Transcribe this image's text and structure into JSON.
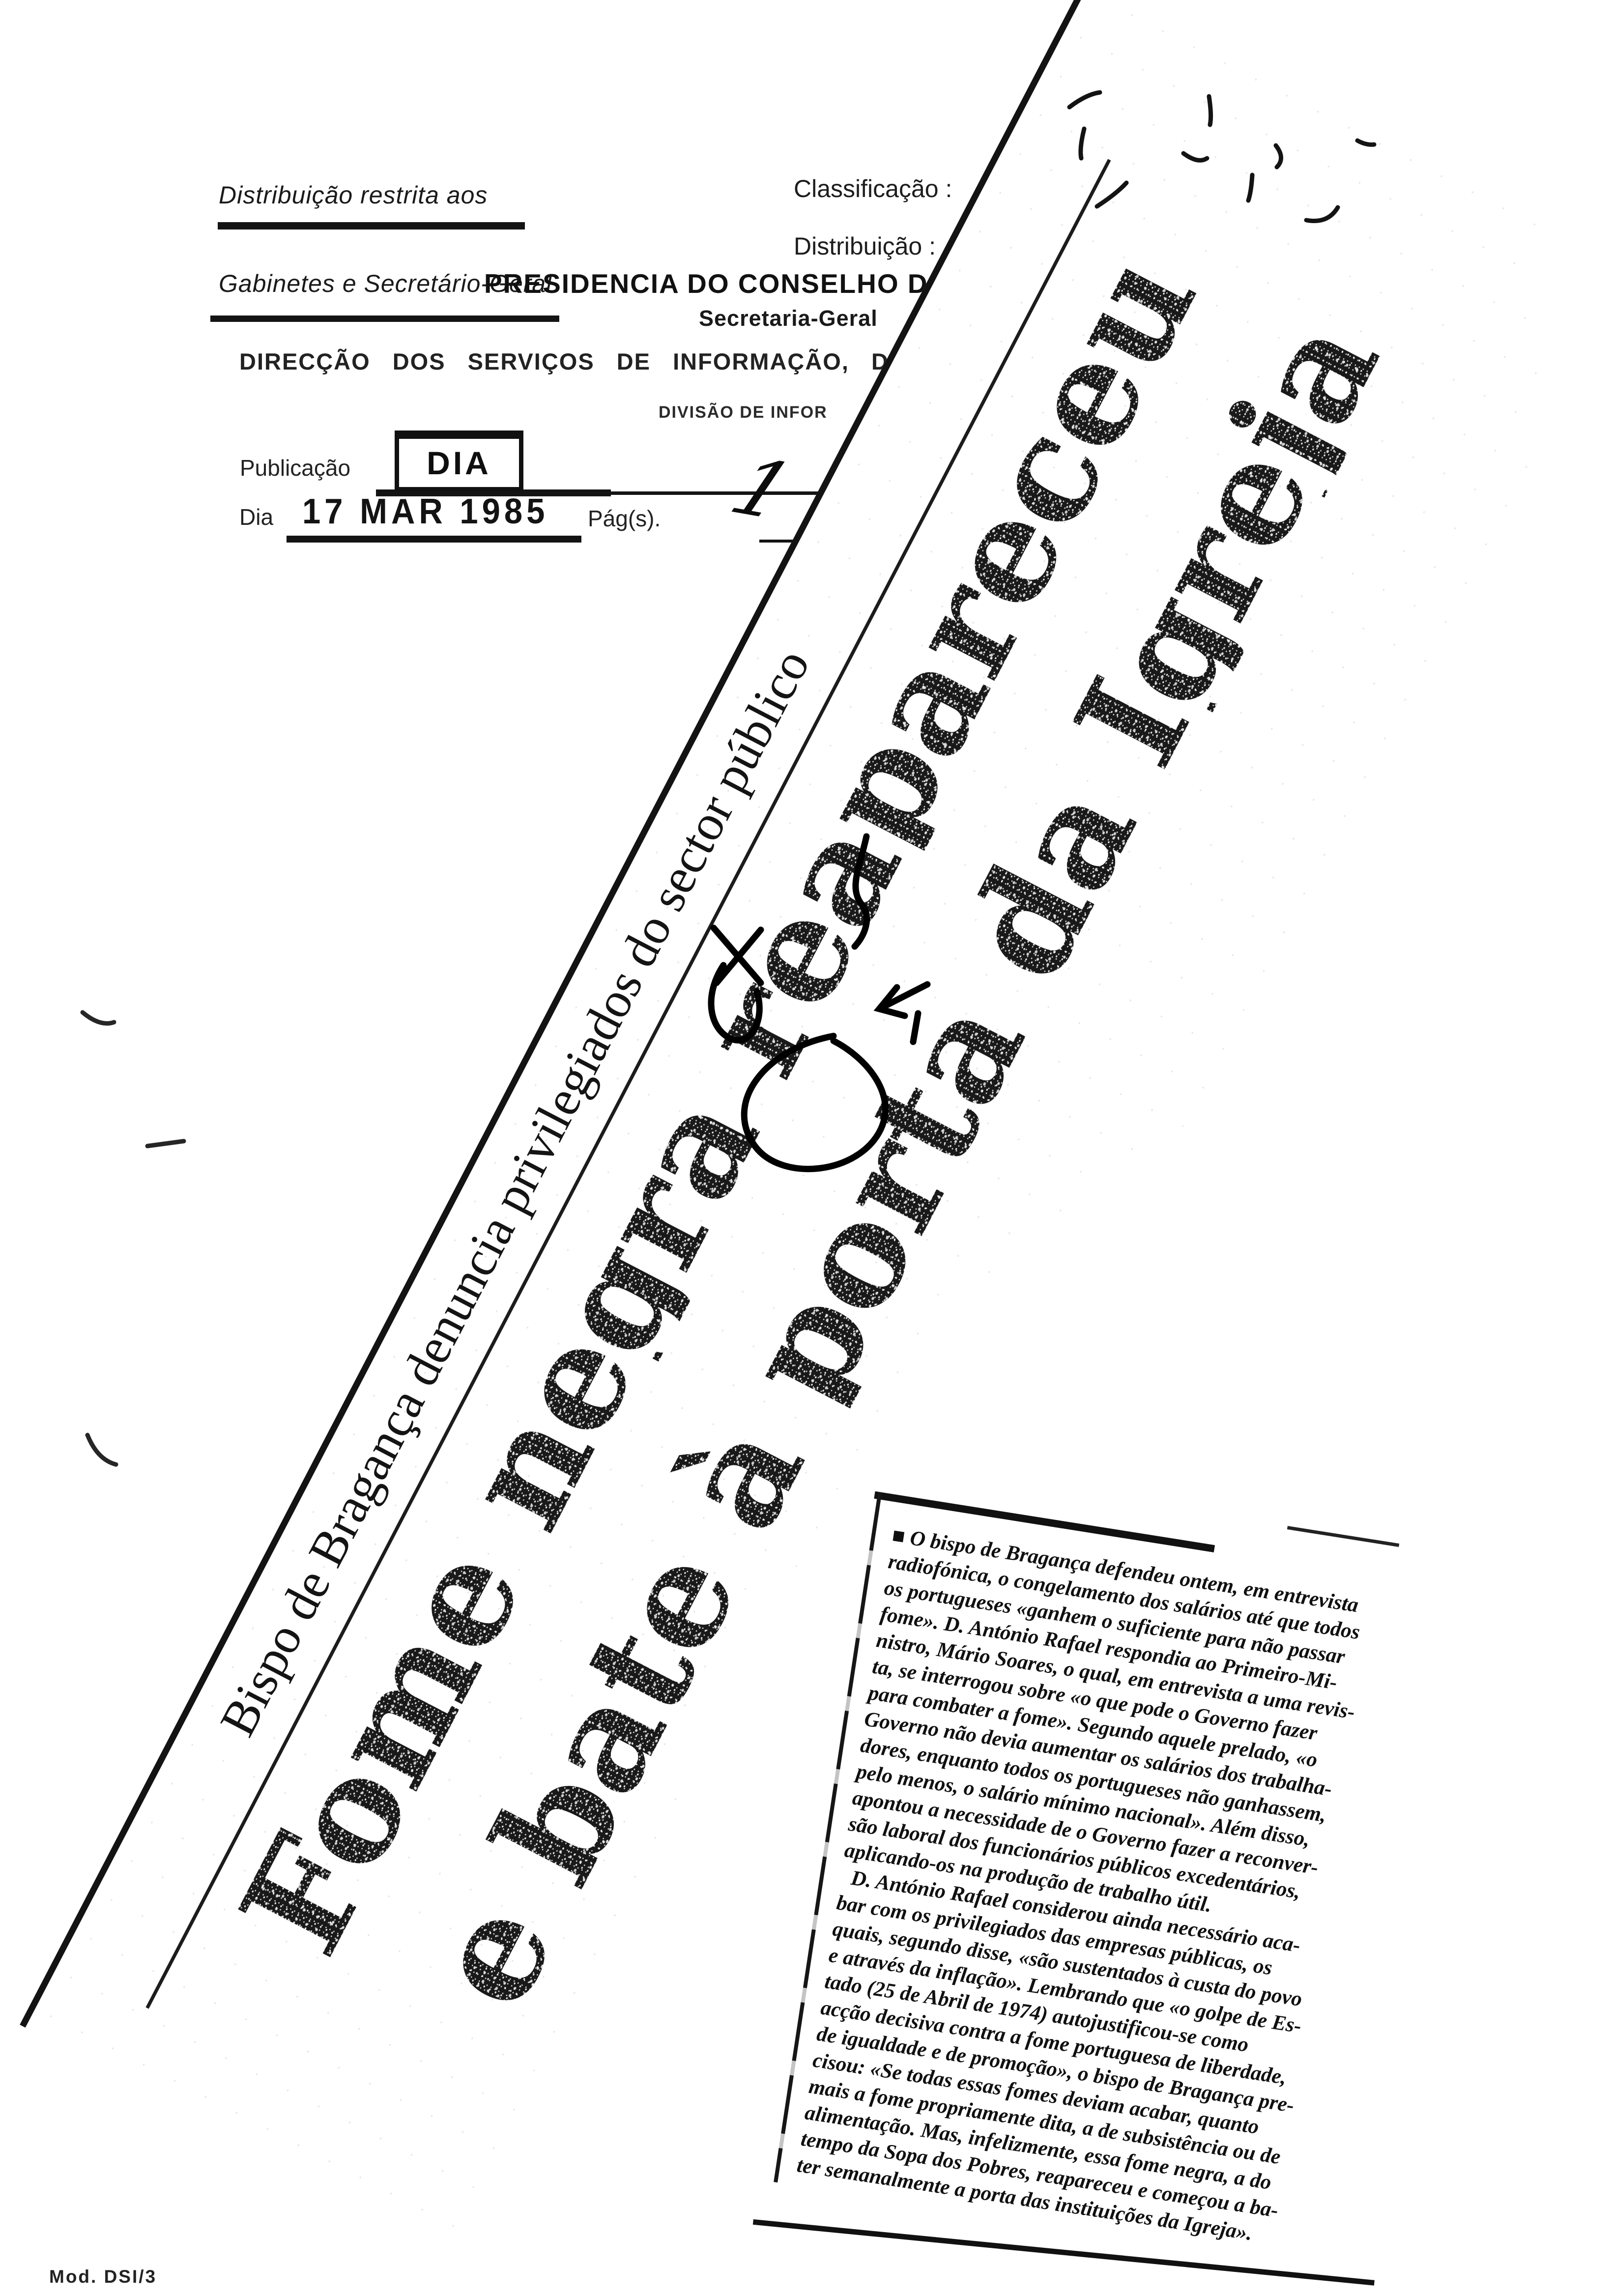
{
  "form": {
    "restricted_note_line1": "Distribuição restrita aos",
    "restricted_note_line2": "Gabinetes e Secretário-Geral",
    "classification_label": "Classificação :",
    "distribution_label": "Distribuição :",
    "org_title": "PRESIDENCIA DO CONSELHO D",
    "org_subtitle": "Secretaria-Geral",
    "org_direction": "DIRECÇÃO DOS SERVIÇOS DE INFORMAÇÃO, DO",
    "org_division": "DIVISÃO DE INFOR",
    "publication_label": "Publicação",
    "publication_value": "DIA",
    "day_label": "Dia",
    "day_value": "17 MAR 1985",
    "pages_label": "Pág(s).",
    "pages_value": "1",
    "model_ref": "Mod. DSI/3"
  },
  "clipping": {
    "kicker": "Bispo de Bragança denuncia privilegiados do sector público",
    "headline_line1": "Fome negra reapareceu",
    "headline_line2": "e bate à porta da Igreja"
  },
  "article": {
    "lines": [
      "■ O bispo de Bragança defendeu ontem, em entrevista",
      "radiofónica, o congelamento dos salários até que todos",
      "os portugueses «ganhem o suficiente para não passar",
      "fome». D. António Rafael respondia ao Primeiro-Mi-",
      "nistro, Mário Soares, o qual, em entrevista a uma revis-",
      "ta, se interrogou sobre «o que pode o Governo fazer",
      "para combater a fome». Segundo aquele prelado, «o",
      "Governo não devia aumentar os salários dos trabalha-",
      "dores, enquanto todos os portugueses não ganhassem,",
      "pelo menos, o salário mínimo nacional». Além disso,",
      "apontou a necessidade de o Governo fazer a reconver-",
      "são laboral dos funcionários públicos excedentários,",
      "aplicando-os na produção de trabalho útil.",
      "  D. António Rafael considerou ainda necessário aca-",
      "bar com os privilegiados das empresas públicas, os",
      "quais, segundo disse, «são sustentados à custa do povo",
      "e através da inflação». Lembrando que «o golpe de Es-",
      "tado (25 de Abril de 1974) autojustificou-se como",
      "acção decisiva contra a fome portuguesa de liberdade,",
      "de igualdade e de promoção», o bispo de Bragança pre-",
      "cisou: «Se todas essas fomes deviam acabar, quanto",
      "mais a fome propriamente dita, a de subsistência ou de",
      "alimentação. Mas, infelizmente, essa fome negra, a do",
      "tempo da Sopa dos Pobres, reapareceu e começou a ba-",
      "ter semanalmente a porta das instituições da Igreja»."
    ]
  },
  "marks": {
    "top_scribble": "handwritten-scribble",
    "center_annotation": "handwritten-annotation",
    "margin_marks": "handwritten-margin-marks"
  }
}
